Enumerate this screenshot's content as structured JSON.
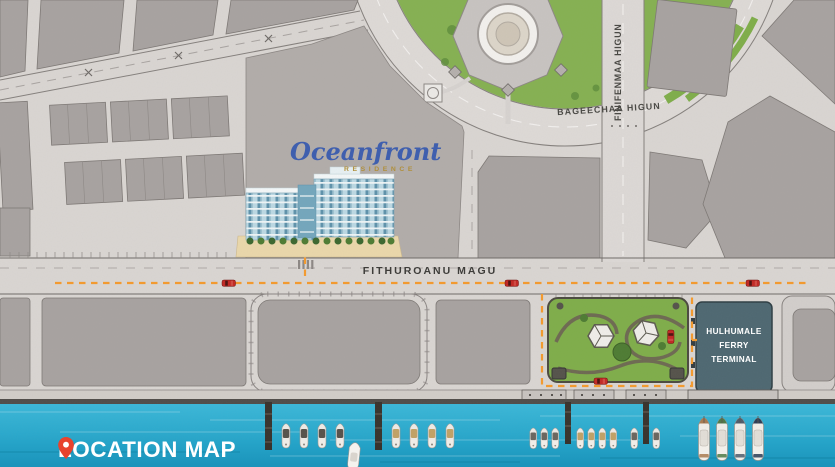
{
  "title": {
    "label": "LOCATION MAP"
  },
  "logo": {
    "name": "Oceanfront",
    "subtitle": "RESIDENCE"
  },
  "streets": {
    "fithuroanu_magu": "FITHUROANU MAGU",
    "bageechaa_higun": "BAGEECHAA HIGUN",
    "finifenmaa_higun": "FINIFENMAA HIGUN"
  },
  "landmarks": {
    "ferry_terminal": {
      "line1": "HULHUMALE FERRY",
      "line2": "TERMINAL"
    }
  },
  "icons": {
    "location_pin": "location-pin-icon"
  },
  "colors": {
    "water": "#29a9cd",
    "ground": "#dad6d3",
    "building_block": "#a8a3a1",
    "park_green": "#7fae4a",
    "terminal_teal": "#4e6872",
    "route_orange": "#f59a2d",
    "car_red": "#c32824",
    "logo_blue": "#3f5fae",
    "logo_gold": "#b08f3c",
    "pin_red": "#e8432e",
    "title_text": "#ffffff"
  }
}
